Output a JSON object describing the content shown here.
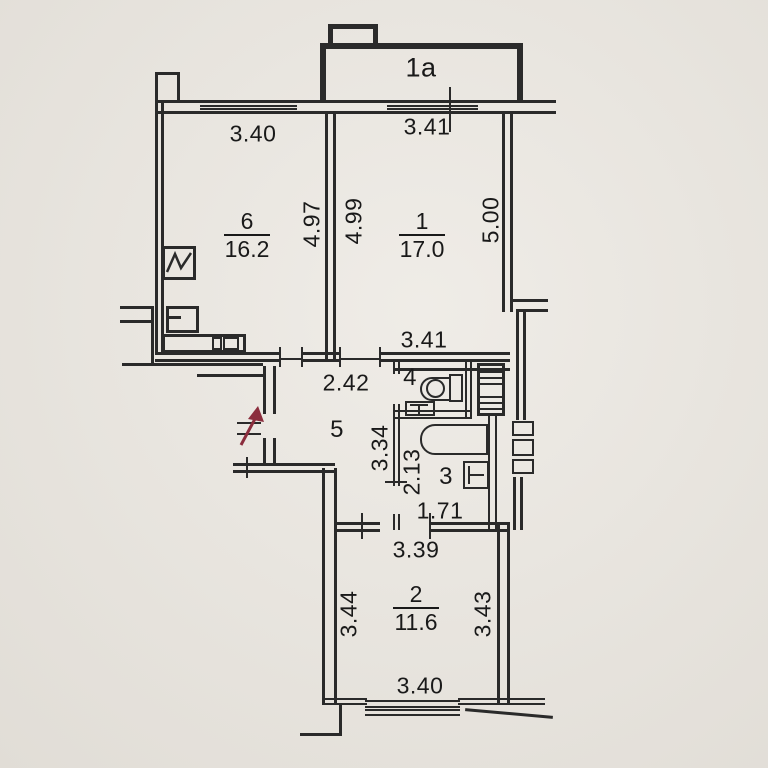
{
  "colors": {
    "paper": "#eae6df",
    "line": "#2a2a2a",
    "balcony_wall": "#2b2b2b",
    "entry_arrow": "#8b2d3d"
  },
  "balcony": {
    "label": "1a"
  },
  "rooms": {
    "r6": {
      "num": "6",
      "area": "16.2"
    },
    "r1": {
      "num": "1",
      "area": "17.0"
    },
    "r5": {
      "num": "5"
    },
    "r4": {
      "num": "4"
    },
    "r3": {
      "num": "3"
    },
    "r2": {
      "num": "2",
      "area": "11.6"
    }
  },
  "dims": {
    "d_top_left": "3.40",
    "d_top_right": "3.41",
    "d_r6_h": "4.97",
    "d_r1_h_left": "4.99",
    "d_r1_h_right": "5.00",
    "d_r1_bottom": "3.41",
    "d_hall_w": "2.42",
    "d_hall_h": "3.34",
    "d_bath_h": "2.13",
    "d_bath_w": "1.71",
    "d_r2_top": "3.39",
    "d_r2_left": "3.44",
    "d_r2_right": "3.43",
    "d_r2_bottom": "3.40"
  }
}
